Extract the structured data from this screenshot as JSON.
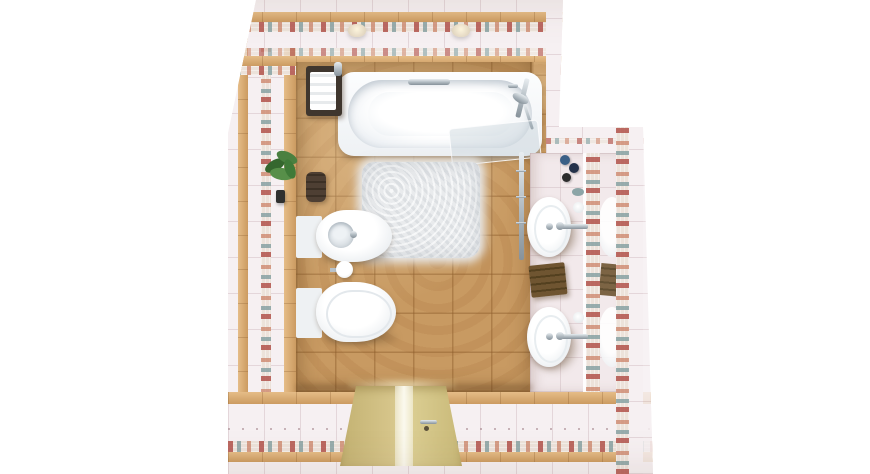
{
  "scene": {
    "type": "3d-interior-render",
    "view": "top-down",
    "room": "bathroom"
  },
  "objects": {
    "bathtub": "Bathtub",
    "shower": "Shower mixer with hand shower",
    "bath_screen": "Glass bath screen",
    "caddy": "Bath shelf with rolled towels",
    "lamp": "Wall lamp",
    "plant": "Decorative green plant",
    "hand_towel": "Dark hanging hand towel",
    "bidet": "Wall-hung bidet",
    "toilet": "Wall-hung toilet",
    "tp_holder": "Toilet paper holder",
    "rug": "White shaggy bath rug",
    "washbasin_top": "Round countertop washbasin (top)",
    "washbasin_bottom": "Round countertop washbasin (bottom)",
    "mirror": "Wall mirror with mosaic trim",
    "towel_stack": "Stack of folded brown towels",
    "toiletries": "Toiletry bottles",
    "towel_rail": "Chrome towel rail",
    "door": "Entrance door with frosted glass insert",
    "door_handle": "Door handle"
  },
  "colors": {
    "floor_tile": "#c89a62",
    "wall_tile": "#f6f0f2",
    "alcove_floor": "#f2e9eb",
    "tan_band": "#d7a66a",
    "mosaic_base": "#ece2da",
    "mosaic_red": "#ae4942",
    "mosaic_teal": "#7a999b",
    "fixture_white": "#fbfcfd",
    "fixture_shadow": "#dde3e8",
    "rug": "#e9ebed",
    "door": "#d5c489",
    "door_glass": "#fbf9ee",
    "chrome": "#aeb8bf",
    "towel_brown": "#6f5531",
    "towel_dark": "#4e3f33",
    "plant_green": "#4a8040"
  }
}
